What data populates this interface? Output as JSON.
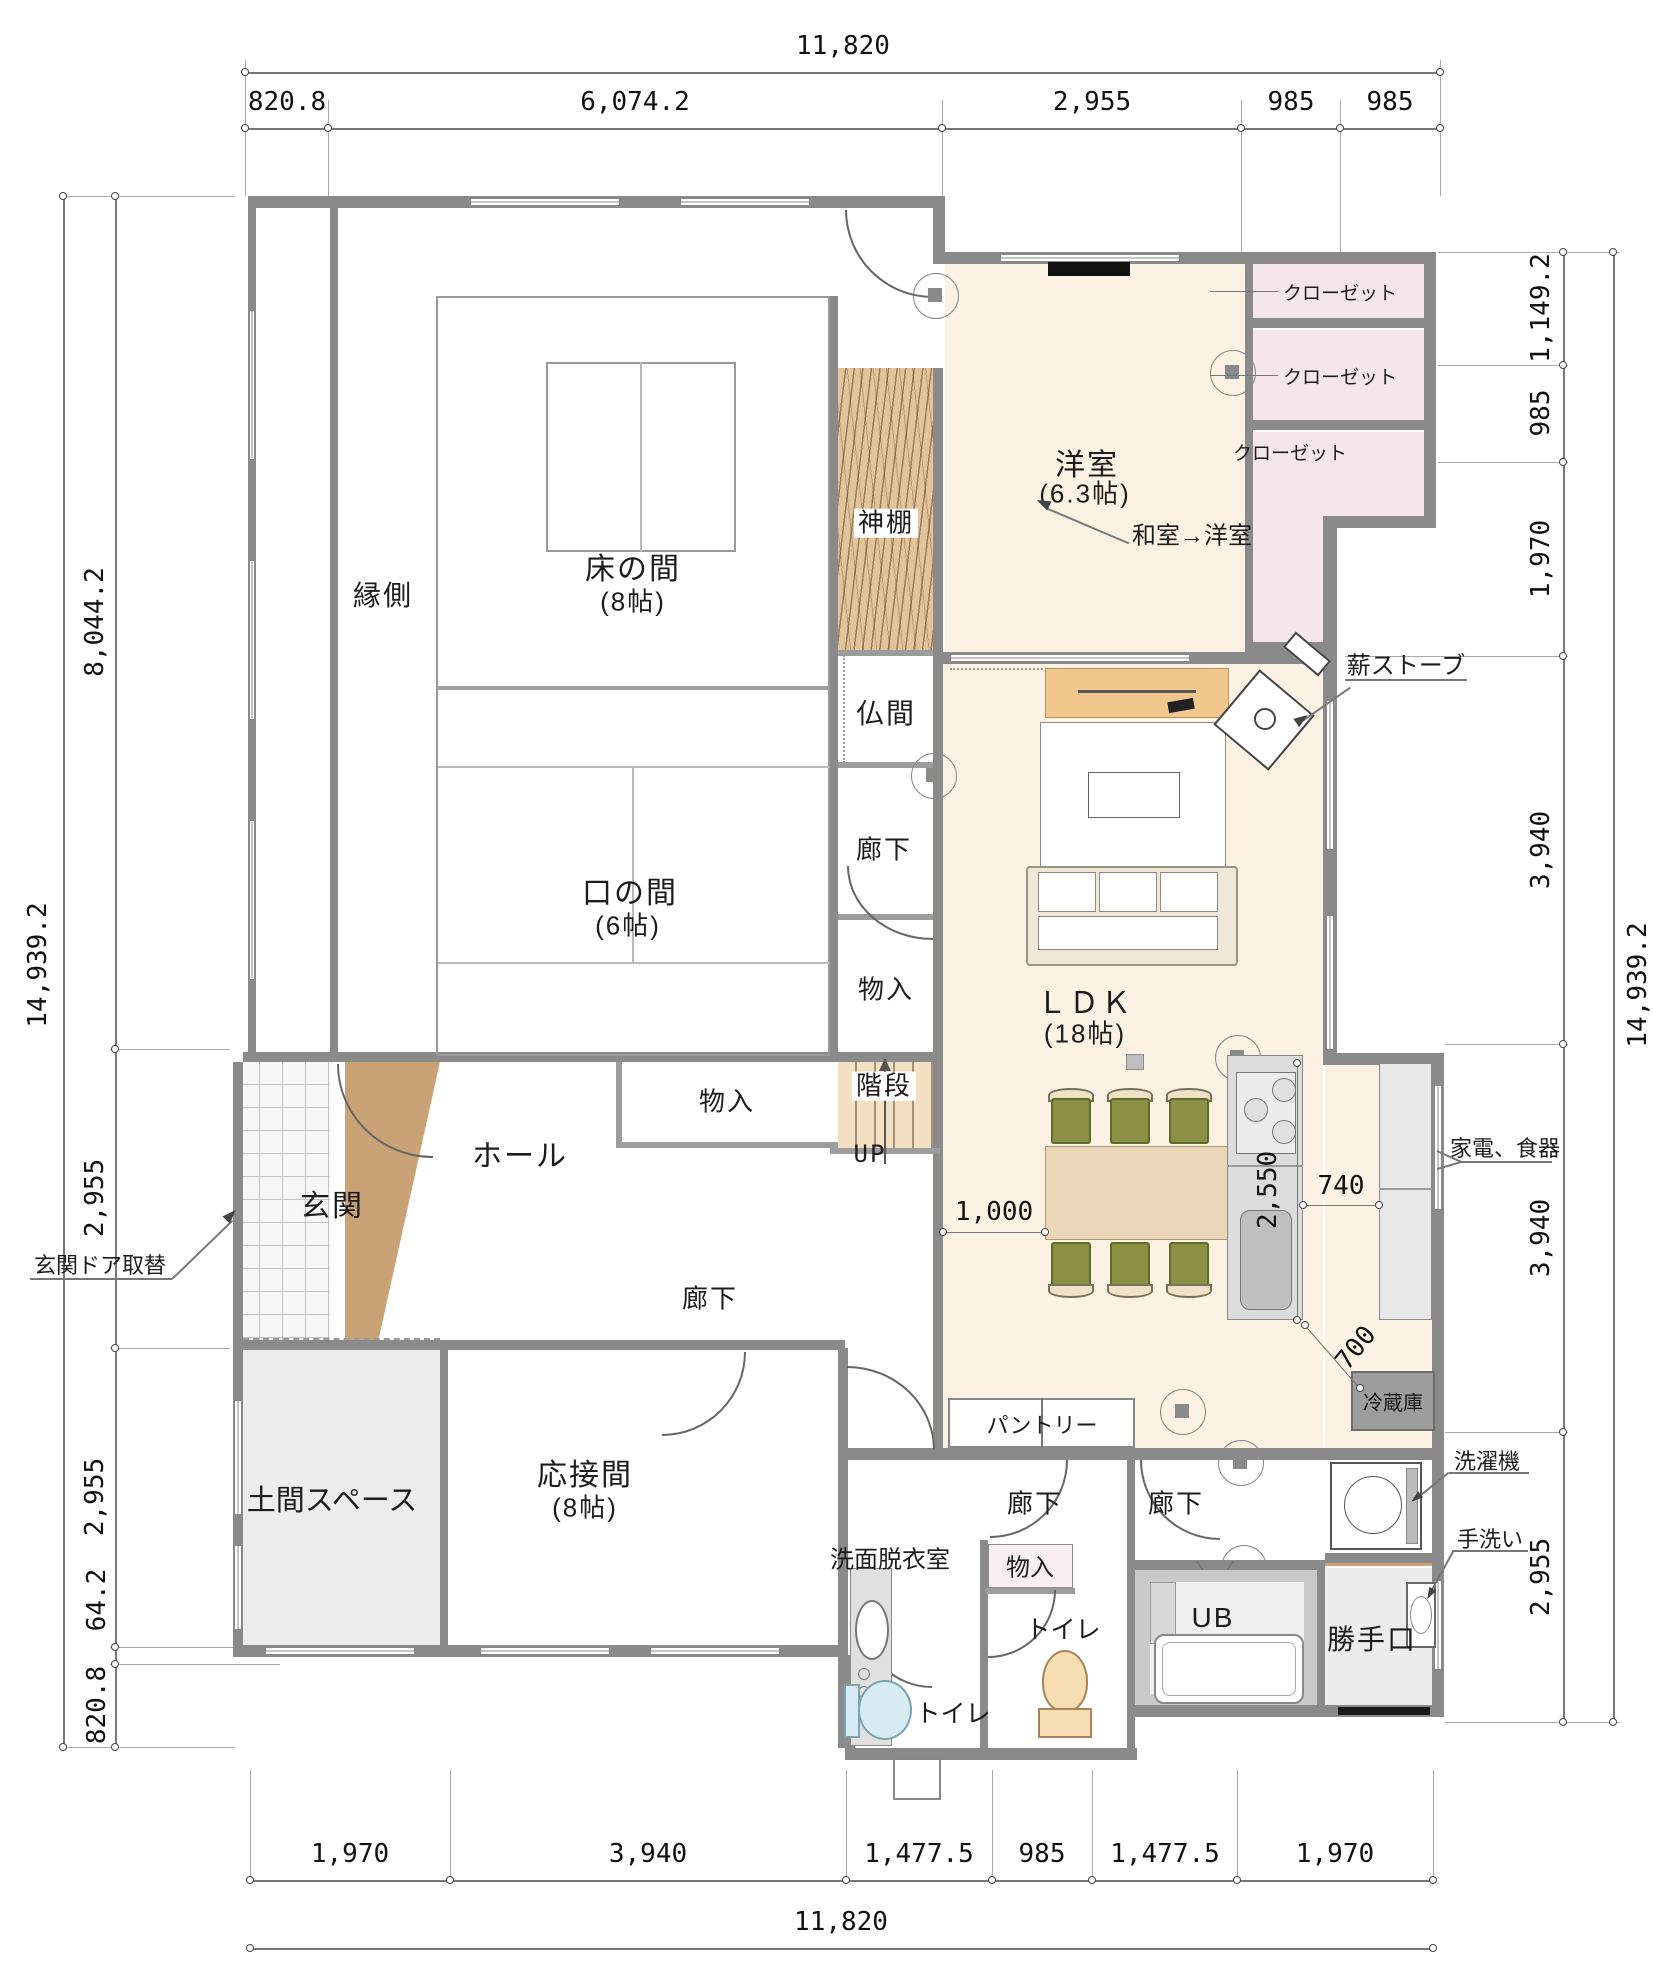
{
  "dimensions": {
    "top": {
      "total": "11,820",
      "segments": [
        "820.8",
        "6,074.2",
        "2,955",
        "985",
        "985"
      ]
    },
    "bottom": {
      "total": "11,820",
      "segments": [
        "1,970",
        "3,940",
        "1,477.5",
        "985",
        "1,477.5",
        "1,970"
      ]
    },
    "left": {
      "total": "14,939.2",
      "segments": [
        "8,044.2",
        "2,955",
        "2,955",
        "64.2",
        "820.8"
      ]
    },
    "right": {
      "total": "14,939.2",
      "segments": [
        "1,149.2",
        "985",
        "1,970",
        "3,940",
        "3,940",
        "2,955"
      ]
    },
    "inline": {
      "dining": "1,000",
      "kitchen": "2,550",
      "aisle": "740",
      "fridge": "700"
    }
  },
  "rooms": {
    "engawa": "縁側",
    "tokonoma": "床の間",
    "tokonoma_size": "(8帖)",
    "kuchinoma": "口の間",
    "kuchinoma_size": "(6帖)",
    "youshitsu": "洋室",
    "youshitsu_size": "(6.3帖)",
    "kamidana": "神棚",
    "butsuma": "仏間",
    "rouka": "廊下",
    "monoiri": "物入",
    "kaidan": "階段",
    "up": "UP",
    "hall": "ホール",
    "genkan": "玄関",
    "doma": "土間スペース",
    "ousetsuma": "応接間",
    "ousetsuma_size": "(8帖)",
    "ldk": "ＬＤＫ",
    "ldk_size": "(18帖)",
    "pantry": "パントリー",
    "reizouko": "冷蔵庫",
    "senmen": "洗面脱衣室",
    "toilet": "トイレ",
    "ub": "UB",
    "katteguchi": "勝手口"
  },
  "annotations": {
    "closet": "クローゼット",
    "washitsu_to_youshitsu": "和室→洋室",
    "maki_stove": "薪ストーブ",
    "kaden_shokki": "家電、食器",
    "genkan_door": "玄関ドア取替",
    "sentakuki": "洗濯機",
    "tearai": "手洗い"
  },
  "colors": {
    "wall": "#8a8a8a",
    "cream_floor": "#fbf2e3",
    "closet_pink": "#f5e6eb",
    "wood_shelf": "#e2c49c",
    "stair_tan": "#f3e0c2",
    "entry_wedge": "#c9a376",
    "doma_gray": "#ededed",
    "chair_olive": "#8a9144",
    "table_tan": "#ead6b8",
    "tv_board": "#f2c78d",
    "counter_gray": "#dcdcdc",
    "fridge_gray": "#9d9d9d"
  }
}
